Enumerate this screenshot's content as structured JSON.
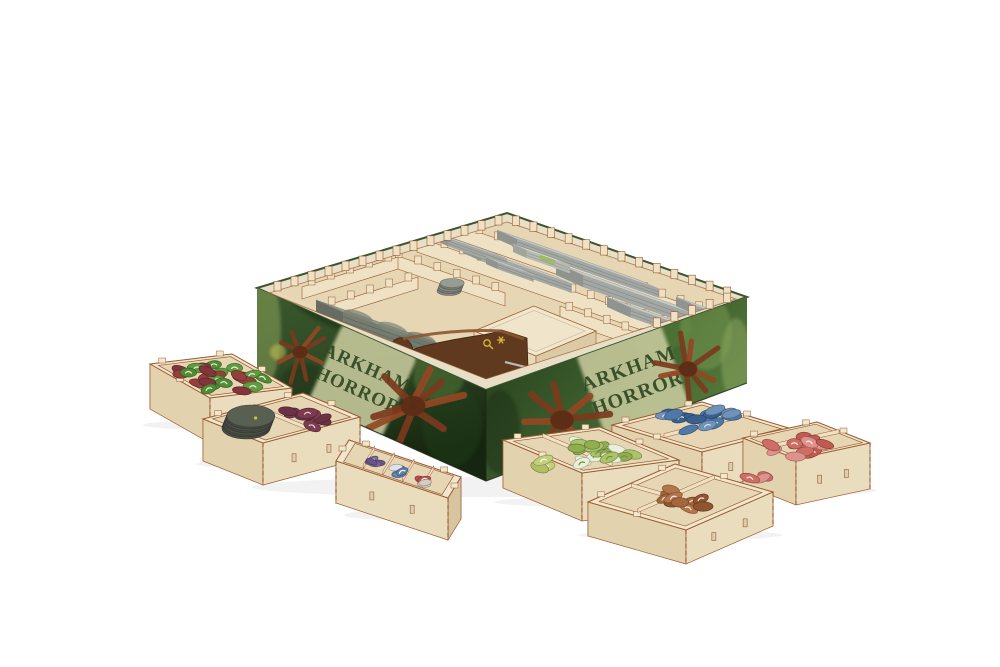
{
  "meta": {
    "description": "Product photo of a laser-cut wooden board game organizer insert inside an Arkham Horror game box, with seven small wooden token trays arranged in front on a white background"
  },
  "box": {
    "title_line1": "ARKHAM",
    "title_line2": "HORROR"
  },
  "palette": {
    "background": "#ffffff",
    "wood_light": "#f1e7cd",
    "wood_face": "#eaddbd",
    "wood_face_left": "#e3d2ae",
    "wood_face_shade": "#d8c49e",
    "wood_floor": "#e6d6b4",
    "wood_interior": "#efe2c4",
    "wood_edge": "#9a5c33",
    "box_green_dark": "#16250f",
    "box_green": "#3a5a2d",
    "box_green_light": "#6d934c",
    "banner": "#c9cb9e",
    "banner_text": "#2f4722",
    "creature": "#7b3a1d",
    "card_gray": "#c8ccc7",
    "card_gray_side": "#a3a8a4",
    "tile_gray": "#949a8c",
    "stand_brown": "#5f3a1e",
    "stand_top": "#8a5733",
    "gold": "#d8b838",
    "rod_silver": "#b9b9b5"
  },
  "scene": {
    "rim_teeth": [
      {
        "from": [
          269,
          293
        ],
        "to": [
          507,
          222
        ],
        "n": 14
      },
      {
        "from": [
          507,
          222
        ],
        "to": [
          736,
          299
        ],
        "n": 13
      },
      {
        "from": [
          736,
          299
        ],
        "to": [
          648,
          330
        ],
        "n": 5
      }
    ],
    "comb_walls": [
      {
        "p1": [
          452,
          238
        ],
        "p2": [
          708,
          327
        ],
        "h": 15,
        "teeth": 14
      },
      {
        "p1": [
          417,
          252
        ],
        "p2": [
          673,
          341
        ],
        "h": 15,
        "teeth": 14
      },
      {
        "p1": [
          560,
          320
        ],
        "p2": [
          728,
          379
        ],
        "h": 14,
        "teeth": 9
      },
      {
        "p1": [
          389,
          266
        ],
        "p2": [
          505,
          306
        ],
        "h": 13,
        "teeth": 6
      },
      {
        "p1": [
          302,
          299
        ],
        "p2": [
          398,
          269
        ],
        "h": 12,
        "teeth": 5
      },
      {
        "p1": [
          322,
          319
        ],
        "p2": [
          418,
          289
        ],
        "h": 12,
        "teeth": 5
      },
      {
        "p1": [
          333,
          349
        ],
        "p2": [
          470,
          397
        ],
        "h": 13,
        "teeth": 7
      }
    ],
    "card_stacks": [
      {
        "p": [
          497,
          230
        ],
        "L": 150,
        "W": 22,
        "s": 9
      },
      {
        "p": [
          463,
          244
        ],
        "L": 96,
        "W": 20,
        "s": 9
      },
      {
        "p": [
          556,
          263
        ],
        "L": 150,
        "W": 30,
        "s": 12
      },
      {
        "p": [
          607,
          297
        ],
        "L": 118,
        "W": 26,
        "s": 10
      },
      {
        "p": [
          434,
          232
        ],
        "L": 62,
        "W": 16,
        "s": 8
      },
      {
        "p": [
          676,
          297
        ],
        "L": 56,
        "W": 22,
        "s": 9
      },
      {
        "p": [
          513,
          244
        ],
        "L": 46,
        "W": 15,
        "s": 8,
        "top": "#dfe2d6",
        "side": "#b6bab0",
        "label": true
      },
      {
        "p": [
          486,
          257
        ],
        "L": 38,
        "W": 13,
        "s": 7,
        "top": "#d6d9d2"
      },
      {
        "p": [
          316,
          300
        ],
        "L": 122,
        "W": 30,
        "s": 14,
        "top": "#949a8c",
        "side": "#747b70",
        "tile": true
      }
    ],
    "compartment": {
      "corners": [
        [
          474,
          331
        ],
        [
          534,
          306
        ],
        [
          596,
          331
        ],
        [
          536,
          356
        ]
      ],
      "h": 26
    },
    "interior_clusters": [
      {
        "type": "stack",
        "cx": 449,
        "cy": 291,
        "rx": 12,
        "ry": 4.5,
        "n": 5,
        "colors": [
          "#878c85",
          "#767b74"
        ],
        "top": "#979c95"
      }
    ],
    "creatures": [
      {
        "cx": 300,
        "cy": 352,
        "r": 27,
        "rot": 0.4,
        "face": "left"
      },
      {
        "cx": 413,
        "cy": 406,
        "r": 44,
        "rot": 0.1,
        "face": "left"
      },
      {
        "cx": 299,
        "cy": 441,
        "r": 29,
        "rot": 1.1,
        "face": "left"
      },
      {
        "cx": 562,
        "cy": 420,
        "r": 42,
        "rot": 0.7,
        "face": "right"
      },
      {
        "cx": 688,
        "cy": 369,
        "r": 33,
        "rot": 0.2,
        "face": "right"
      }
    ],
    "blobs": [
      {
        "cx": 265,
        "cy": 330,
        "rx": 16,
        "ry": 55,
        "fill": "#93a95e",
        "op": 0.5,
        "rot": 0,
        "face": "left"
      },
      {
        "cx": 278,
        "cy": 352,
        "rx": 8,
        "ry": 8,
        "fill": "#c9c05a",
        "op": 0.55,
        "rot": 0,
        "face": "left"
      },
      {
        "cx": 300,
        "cy": 468,
        "rx": 7,
        "ry": 5,
        "fill": "#c9c05a",
        "op": 0.4,
        "rot": 0,
        "face": "left"
      },
      {
        "cx": 330,
        "cy": 312,
        "rx": 44,
        "ry": 13,
        "fill": "#16270f",
        "op": 0.45,
        "rot": 24,
        "face": "left"
      },
      {
        "cx": 370,
        "cy": 455,
        "rx": 64,
        "ry": 16,
        "fill": "#14240e",
        "op": 0.5,
        "rot": 24,
        "face": "left"
      },
      {
        "cx": 452,
        "cy": 425,
        "rx": 30,
        "ry": 42,
        "fill": "#23401c",
        "op": 0.45,
        "rot": 0,
        "face": "left"
      },
      {
        "cx": 440,
        "cy": 372,
        "rx": 26,
        "ry": 30,
        "fill": "#587c3b",
        "op": 0.5,
        "rot": 24,
        "face": "left"
      },
      {
        "cx": 305,
        "cy": 398,
        "rx": 30,
        "ry": 35,
        "fill": "#1a2f13",
        "op": 0.4,
        "rot": 0,
        "face": "left"
      },
      {
        "cx": 500,
        "cy": 432,
        "rx": 20,
        "ry": 42,
        "fill": "#1a2e12",
        "op": 0.5,
        "rot": 0,
        "face": "right"
      },
      {
        "cx": 545,
        "cy": 348,
        "rx": 52,
        "ry": 15,
        "fill": "#16270f",
        "op": 0.45,
        "rot": -20,
        "face": "right"
      },
      {
        "cx": 600,
        "cy": 452,
        "rx": 62,
        "ry": 15,
        "fill": "#1a2d11",
        "op": 0.5,
        "rot": -20,
        "face": "right"
      },
      {
        "cx": 662,
        "cy": 332,
        "rx": 30,
        "ry": 20,
        "fill": "#5a7f3e",
        "op": 0.5,
        "rot": -20,
        "face": "right"
      },
      {
        "cx": 706,
        "cy": 332,
        "rx": 26,
        "ry": 38,
        "fill": "#7fa057",
        "op": 0.45,
        "rot": 0,
        "face": "right"
      },
      {
        "cx": 736,
        "cy": 360,
        "rx": 15,
        "ry": 42,
        "fill": "#8fa862",
        "op": 0.5,
        "rot": 0,
        "face": "right"
      },
      {
        "cx": 645,
        "cy": 437,
        "rx": 8,
        "ry": 6,
        "fill": "#c9c05a",
        "op": 0.5,
        "rot": 0,
        "face": "right"
      },
      {
        "cx": 580,
        "cy": 332,
        "rx": 30,
        "ry": 18,
        "fill": "#43652f",
        "op": 0.5,
        "rot": -20,
        "face": "right"
      }
    ],
    "trays": [
      {
        "name": "blue-tokens-tray",
        "corners": [
          [
            612,
            425
          ],
          [
            702,
            402
          ],
          [
            792,
            429
          ],
          [
            702,
            452
          ]
        ],
        "h": 40,
        "dividers": [
          {
            "a": {
              "e": 2,
              "f": 0.52
            },
            "b": {
              "e": 3,
              "f": 0.52
            }
          }
        ],
        "clusters": [
          {
            "cx": 700,
            "cy": 420,
            "rx": 38,
            "ry": 13,
            "n": 16,
            "colors": [
              "#4d78a8",
              "#3b6090",
              "#6e92ba"
            ],
            "glyph": "#dde4ec"
          }
        ]
      },
      {
        "name": "red-tokens-tray",
        "corners": [
          [
            743,
            438
          ],
          [
            817,
            422
          ],
          [
            870,
            443
          ],
          [
            796,
            459
          ]
        ],
        "h": 46,
        "dividers": [
          {
            "a": {
              "e": 2,
              "f": 0.5
            },
            "b": {
              "e": 3,
              "f": 0.5
            }
          }
        ],
        "clusters": [
          {
            "cx": 797,
            "cy": 447,
            "rx": 30,
            "ry": 12,
            "n": 13,
            "colors": [
              "#cf6d65",
              "#e0918a",
              "#c25a52"
            ],
            "glyph": "#f4eee6"
          },
          {
            "cx": 757,
            "cy": 476,
            "rx": 9,
            "ry": 5,
            "n": 3,
            "colors": [
              "#cf6d65",
              "#e0918a"
            ],
            "glyph": "#f4eee6"
          }
        ]
      },
      {
        "name": "green-red-tokens-tray",
        "corners": [
          [
            150,
            364
          ],
          [
            232,
            354
          ],
          [
            292,
            388
          ],
          [
            210,
            398
          ]
        ],
        "h": 45,
        "dividers": [],
        "clusters": [
          {
            "cx": 220,
            "cy": 378,
            "rx": 46,
            "ry": 15,
            "n": 24,
            "colors": [
              "#5e9c3e",
              "#94403a",
              "#4f8c34",
              "#83343c"
            ],
            "glyph": "#f0ece2"
          }
        ]
      },
      {
        "name": "disc-maroon-tokens-tray",
        "corners": [
          [
            203,
            419
          ],
          [
            303,
            393
          ],
          [
            360,
            417
          ],
          [
            263,
            443
          ]
        ],
        "h": 42,
        "dividers": [
          {
            "a": {
              "e": 0,
              "f": 0.47
            },
            "b": {
              "e": 1,
              "f": 0.47
            }
          }
        ],
        "clusters": [
          {
            "type": "stack",
            "cx": 246,
            "cy": 428,
            "rx": 24,
            "ry": 11,
            "n": 7,
            "colors": [
              "#4d5247",
              "#434840"
            ],
            "top": "#596052",
            "dot": "#c8c832"
          },
          {
            "cx": 305,
            "cy": 417,
            "rx": 24,
            "ry": 10,
            "n": 9,
            "colors": [
              "#7c3b50",
              "#6b3246"
            ],
            "glyph": "#e6d9ce"
          }
        ]
      },
      {
        "name": "green-tokens-tray",
        "corners": [
          [
            503,
            440
          ],
          [
            600,
            427
          ],
          [
            679,
            460
          ],
          [
            582,
            473
          ]
        ],
        "h": 48,
        "dividers": [
          {
            "a": {
              "e": 0,
              "f": 0.34
            },
            "b": {
              "e": 1,
              "f": 0.34
            }
          }
        ],
        "clusters": [
          {
            "cx": 547,
            "cy": 464,
            "rx": 12,
            "ry": 6,
            "n": 3,
            "colors": [
              "#c3d078",
              "#afc063"
            ],
            "glyph": "#ffffff"
          },
          {
            "cx": 601,
            "cy": 452,
            "rx": 33,
            "ry": 14,
            "n": 18,
            "colors": [
              "#e9efd8",
              "#aac468",
              "#90ad50"
            ],
            "glyph": "#70923f"
          }
        ]
      },
      {
        "name": "small-tokens-sorter-tray",
        "corners": [
          [
            349,
            440
          ],
          [
            461,
            477
          ],
          [
            448,
            498
          ],
          [
            336,
            461
          ]
        ],
        "h": 42,
        "dividers": [
          {
            "a": {
              "e": 0,
              "f": 0.2
            },
            "b": {
              "e": 1,
              "f": 0.2
            }
          },
          {
            "a": {
              "e": 0,
              "f": 0.4
            },
            "b": {
              "e": 1,
              "f": 0.4
            }
          },
          {
            "a": {
              "e": 0,
              "f": 0.6
            },
            "b": {
              "e": 1,
              "f": 0.6
            }
          },
          {
            "a": {
              "e": 0,
              "f": 0.8
            },
            "b": {
              "e": 1,
              "f": 0.8
            }
          }
        ],
        "clusters": [
          {
            "cx": 376,
            "cy": 461,
            "rx": 8,
            "ry": 4,
            "n": 4,
            "size": [
              6.5,
              3.2
            ],
            "colors": [
              "#7a6898",
              "#66558a"
            ],
            "glyph": "#dddddd"
          },
          {
            "cx": 399,
            "cy": 471,
            "rx": 8,
            "ry": 4,
            "n": 5,
            "size": [
              6.5,
              3.2
            ],
            "colors": [
              "#5d7fae",
              "#dfe3e7"
            ],
            "glyph": "#ffffff"
          },
          {
            "cx": 424,
            "cy": 482,
            "rx": 8,
            "ry": 4,
            "n": 4,
            "size": [
              6.5,
              3.2
            ],
            "colors": [
              "#bf4f4f",
              "#d6cec0"
            ],
            "glyph": "#eeeeee"
          }
        ]
      },
      {
        "name": "brown-tokens-tray",
        "corners": [
          [
            588,
            502
          ],
          [
            675,
            464
          ],
          [
            773,
            492
          ],
          [
            686,
            530
          ]
        ],
        "h": 34,
        "dividers": [
          {
            "a": {
              "e": 2,
              "f": 0.45
            },
            "b": {
              "e": 3,
              "f": 0.45
            }
          },
          {
            "a": {
              "e": 0,
              "f": 0.42
            },
            "b": {
              "e": 1,
              "f": 0.42
            },
            "t1": 0.45
          }
        ],
        "clusters": [
          {
            "cx": 688,
            "cy": 498,
            "rx": 30,
            "ry": 12,
            "n": 10,
            "colors": [
              "#a4663c",
              "#8f5530",
              "#b5754a"
            ],
            "glyph": "#efe5d8"
          }
        ]
      }
    ]
  }
}
